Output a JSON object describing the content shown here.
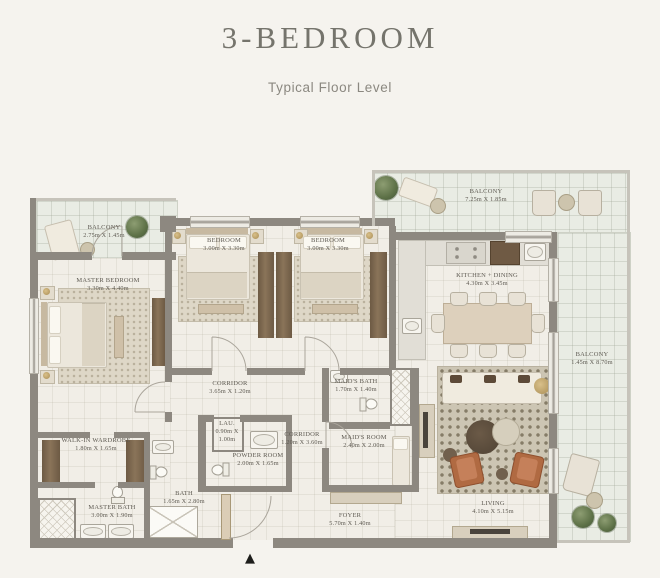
{
  "header": {
    "title": "3-BEDROOM",
    "subtitle": "Typical Floor Level"
  },
  "entry_marker": "▲",
  "colors": {
    "background": "#f5f3ee",
    "wall": "#8d8880",
    "floor": "#f1eee7",
    "balcony_floor": "#e9ece4",
    "label_text": "#5e5a52",
    "title_text": "#75746c",
    "subtitle_text": "#8b8880",
    "wood": "#7c6951",
    "accent_chair": "#b06a42",
    "plant": "#5c7046",
    "entry_marker": "#1d1d1b"
  },
  "rooms": {
    "balcony_tl": {
      "label": "BALCONY",
      "dims": "2.75m X 1.45m"
    },
    "master_bedroom": {
      "label": "MASTER BEDROOM",
      "dims": "3.30m X 4.40m"
    },
    "bedroom_1": {
      "label": "BEDROOM",
      "dims": "3.00m X 3.30m"
    },
    "bedroom_2": {
      "label": "BEDROOM",
      "dims": "3.00m X 3.30m"
    },
    "balcony_tr": {
      "label": "BALCONY",
      "dims": "7.25m X 1.85m"
    },
    "kitchen_dining": {
      "label": "KITCHEN + DINING",
      "dims": "4.30m X 3.45m"
    },
    "balcony_right": {
      "label": "BALCONY",
      "dims": "1.45m X 8.70m"
    },
    "corridor_1": {
      "label": "CORRIDOR",
      "dims": "3.65m X 1.20m"
    },
    "maids_bath": {
      "label": "MAID'S BATH",
      "dims": "1.70m X 1.40m"
    },
    "maids_room": {
      "label": "MAID'S ROOM",
      "dims": "2.40m X 2.00m"
    },
    "laundry": {
      "label": "LAU.",
      "dims": "0.90m X 1.00m"
    },
    "corridor_2": {
      "label": "CORRIDOR",
      "dims": "1.20m X 3.60m"
    },
    "powder_room": {
      "label": "POWDER ROOM",
      "dims": "2.00m X 1.65m"
    },
    "walk_in_wardrobe": {
      "label": "WALK-IN WARDROBE",
      "dims": "1.80m X 1.65m"
    },
    "master_bath": {
      "label": "MASTER BATH",
      "dims": "3.00m X 1.90m"
    },
    "bath": {
      "label": "BATH",
      "dims": "1.65m X 2.80m"
    },
    "foyer": {
      "label": "FOYER",
      "dims": "5.70m X 1.40m"
    },
    "living": {
      "label": "LIVING",
      "dims": "4.10m X 5.15m"
    }
  }
}
